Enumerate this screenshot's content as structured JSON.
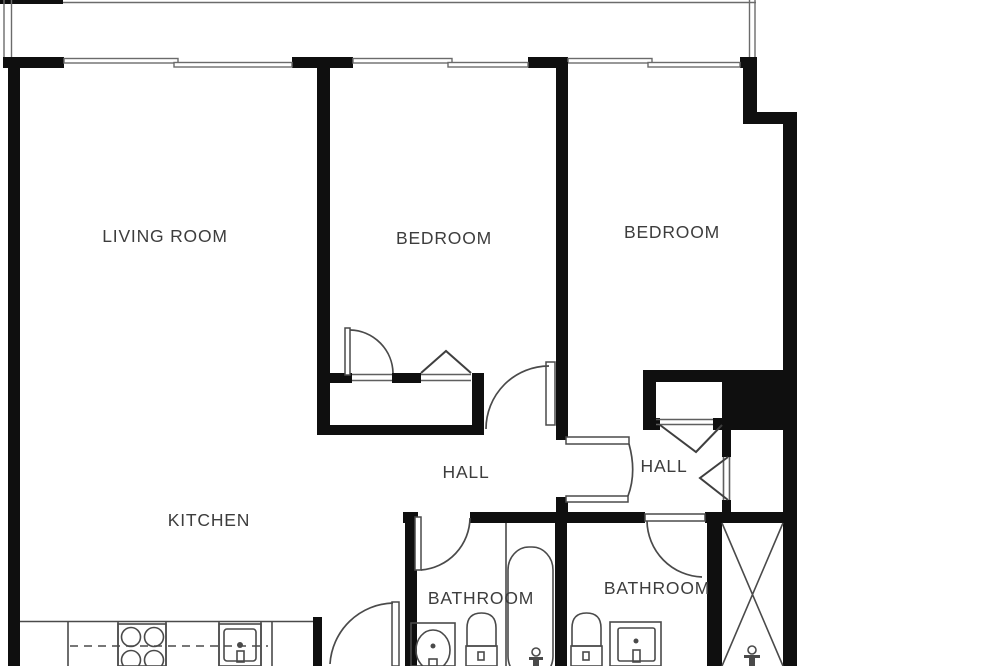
{
  "floor_plan": {
    "type": "apartment-floor-plan",
    "labels": {
      "living_room": "LIVING ROOM",
      "bedroom_1": "BEDROOM",
      "bedroom_2": "BEDROOM",
      "kitchen": "KITCHEN",
      "hall_1": "HALL",
      "hall_2": "HALL",
      "bathroom_1": "BATHROOM",
      "bathroom_2": "BATHROOM"
    },
    "colors": {
      "wall": "#0f0f0f",
      "thin_line": "#5f5f5f",
      "text": "#3d3d3d",
      "background": "#ffffff"
    }
  }
}
